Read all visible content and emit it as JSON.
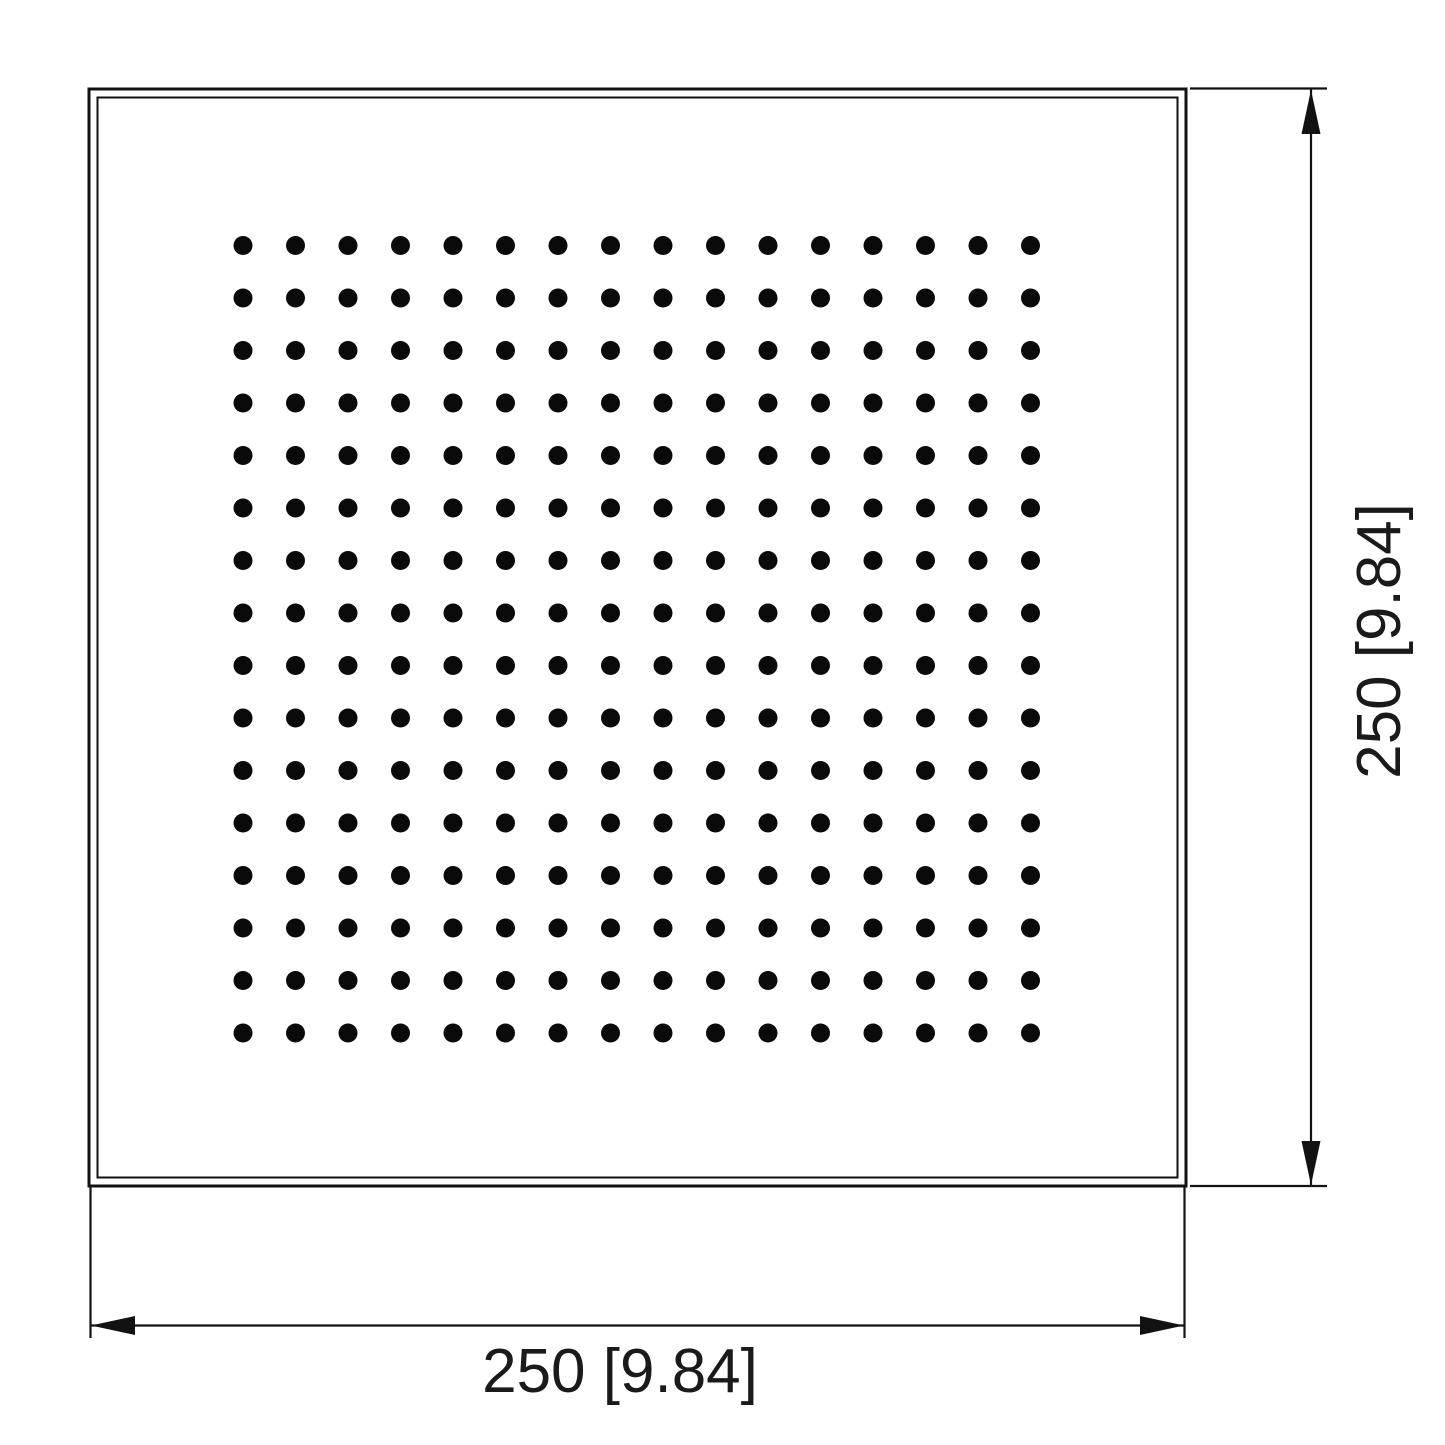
{
  "drawing": {
    "title": "Square shower head face plate - dimensioned technical drawing",
    "view": "top view",
    "background_color": "#ffffff",
    "line_color": "#121212",
    "text_color": "#1a1a1a",
    "faceplate": {
      "shape": "square",
      "border_style": "double outline"
    },
    "nozzle_grid": {
      "rows": 16,
      "cols": 16,
      "total_dots": 256,
      "dot_color": "#0a0a0a"
    },
    "width_dimension": {
      "label": "250 [9.84]",
      "value_mm": 250,
      "value_in": 9.84,
      "orientation": "horizontal",
      "position": "bottom"
    },
    "height_dimension": {
      "label": "250 [9.84]",
      "value_mm": 250,
      "value_in": 9.84,
      "orientation": "vertical-rotated-90ccw",
      "position": "right"
    }
  }
}
